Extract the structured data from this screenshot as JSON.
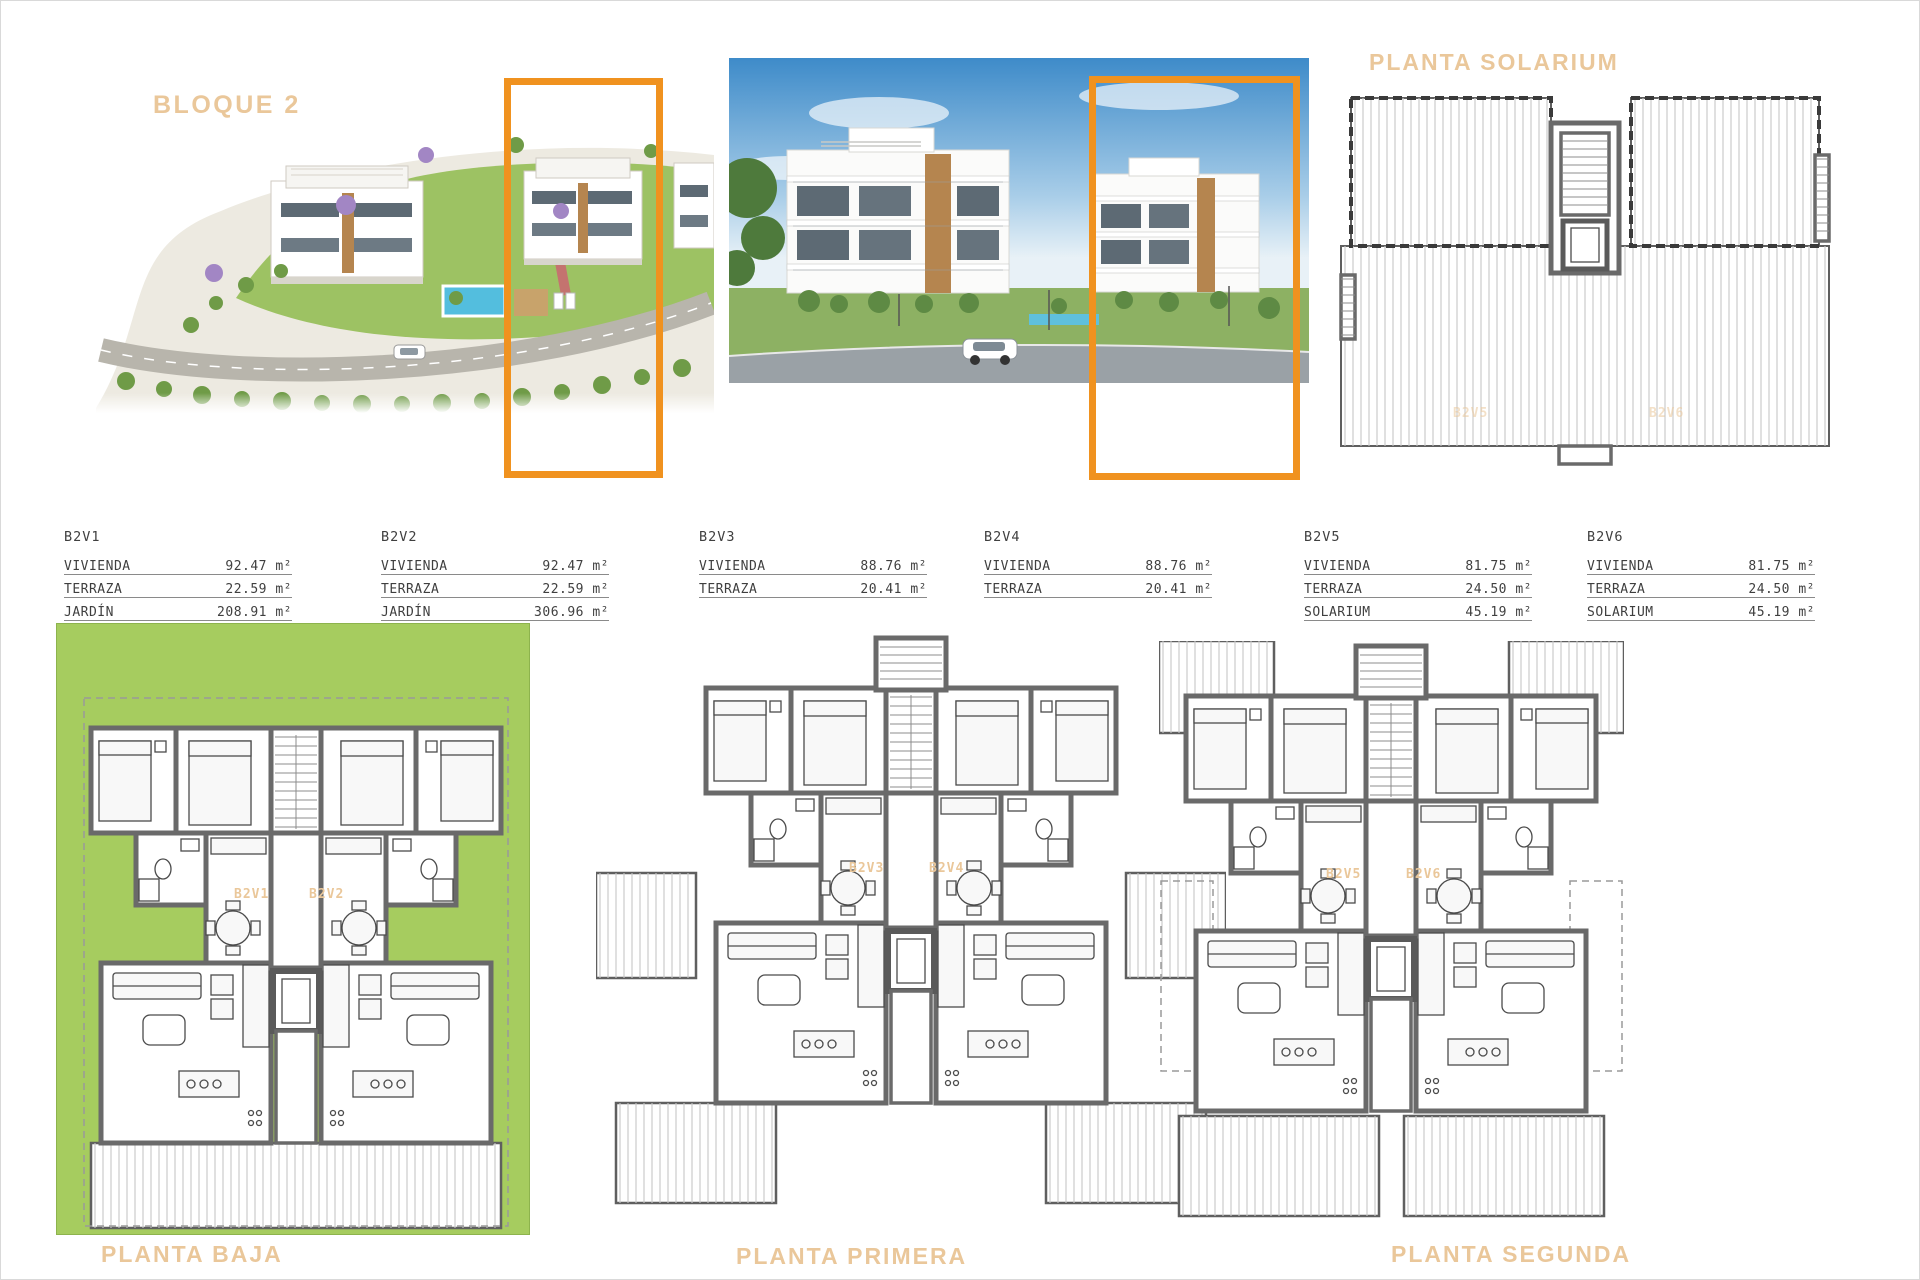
{
  "sheet": {
    "bloque_label": "BLOQUE 2",
    "solarium_title": "PLANTA SOLARIUM",
    "floors": [
      {
        "key": "baja",
        "label": "PLANTA BAJA",
        "units": [
          "B2V1",
          "B2V2"
        ]
      },
      {
        "key": "primera",
        "label": "PLANTA PRIMERA",
        "units": [
          "B2V3",
          "B2V4"
        ]
      },
      {
        "key": "segunda",
        "label": "PLANTA SEGUNDA",
        "units": [
          "B2V5",
          "B2V6"
        ]
      }
    ],
    "solarium_units": [
      "B2V5",
      "B2V6"
    ]
  },
  "units": [
    {
      "id": "B2V1",
      "rows": [
        [
          "VIVIENDA",
          "92.47 m²"
        ],
        [
          "TERRAZA",
          "22.59 m²"
        ],
        [
          "JARDÍN",
          "208.91 m²"
        ]
      ]
    },
    {
      "id": "B2V2",
      "rows": [
        [
          "VIVIENDA",
          "92.47 m²"
        ],
        [
          "TERRAZA",
          "22.59 m²"
        ],
        [
          "JARDÍN",
          "306.96 m²"
        ]
      ]
    },
    {
      "id": "B2V3",
      "rows": [
        [
          "VIVIENDA",
          "88.76 m²"
        ],
        [
          "TERRAZA",
          "20.41 m²"
        ]
      ]
    },
    {
      "id": "B2V4",
      "rows": [
        [
          "VIVIENDA",
          "88.76 m²"
        ],
        [
          "TERRAZA",
          "20.41 m²"
        ]
      ]
    },
    {
      "id": "B2V5",
      "rows": [
        [
          "VIVIENDA",
          "81.75 m²"
        ],
        [
          "TERRAZA",
          "24.50 m²"
        ],
        [
          "SOLARIUM",
          "45.19 m²"
        ]
      ]
    },
    {
      "id": "B2V6",
      "rows": [
        [
          "VIVIENDA",
          "81.75 m²"
        ],
        [
          "TERRAZA",
          "24.50 m²"
        ],
        [
          "SOLARIUM",
          "45.19 m²"
        ]
      ]
    }
  ],
  "colors": {
    "accent_tan": "#eac79a",
    "highlight_orange": "#f0921f",
    "garden_green": "#a6cc5f",
    "wall_grey": "#6a6a6a",
    "table_text": "#3f3f3f",
    "sky_blue": "#3e8bc9",
    "pool_blue": "#53bede"
  }
}
